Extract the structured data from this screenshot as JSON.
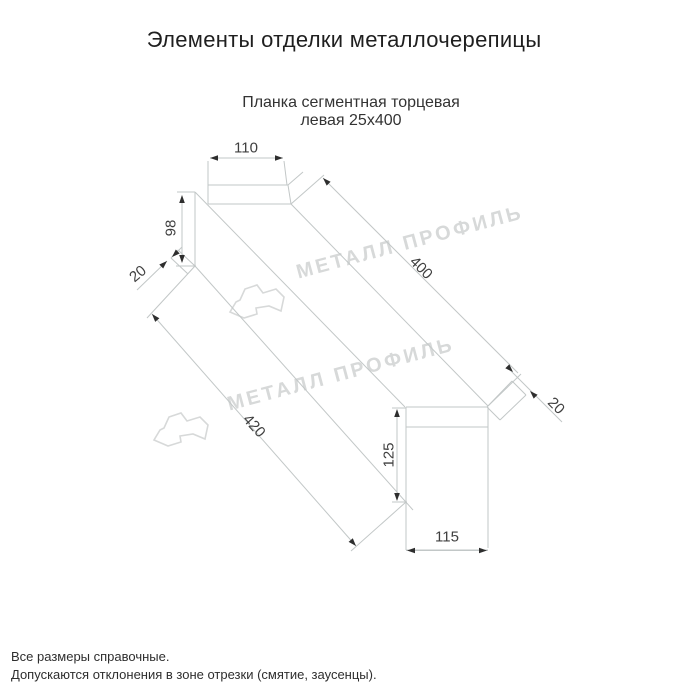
{
  "page": {
    "title": "Элементы отделки металлочерепицы",
    "subtitle_line1": "Планка сегментная торцевая",
    "subtitle_line2": "левая 25x400"
  },
  "dimensions": {
    "flange_top_width": "110",
    "far_end_height": "98",
    "far_end_hem": "20",
    "top_edge_length": "400",
    "near_end_hem": "20",
    "bottom_edge_length": "420",
    "near_end_height": "125",
    "near_end_width": "115"
  },
  "watermark": {
    "text": "МЕТАЛЛ ПРОФИЛЬ"
  },
  "footnotes": {
    "line1": "Все размеры справочные.",
    "line2": "Допускаются отклонения в зоне отрезки (смятие, заусенцы)."
  },
  "colors": {
    "drawing_line": "#c2c7c7",
    "dimension_text": "#3f3f3f",
    "arrow": "#2e2e2e",
    "watermark": "#d7d9d9",
    "title_text": "#1f1f1f"
  }
}
